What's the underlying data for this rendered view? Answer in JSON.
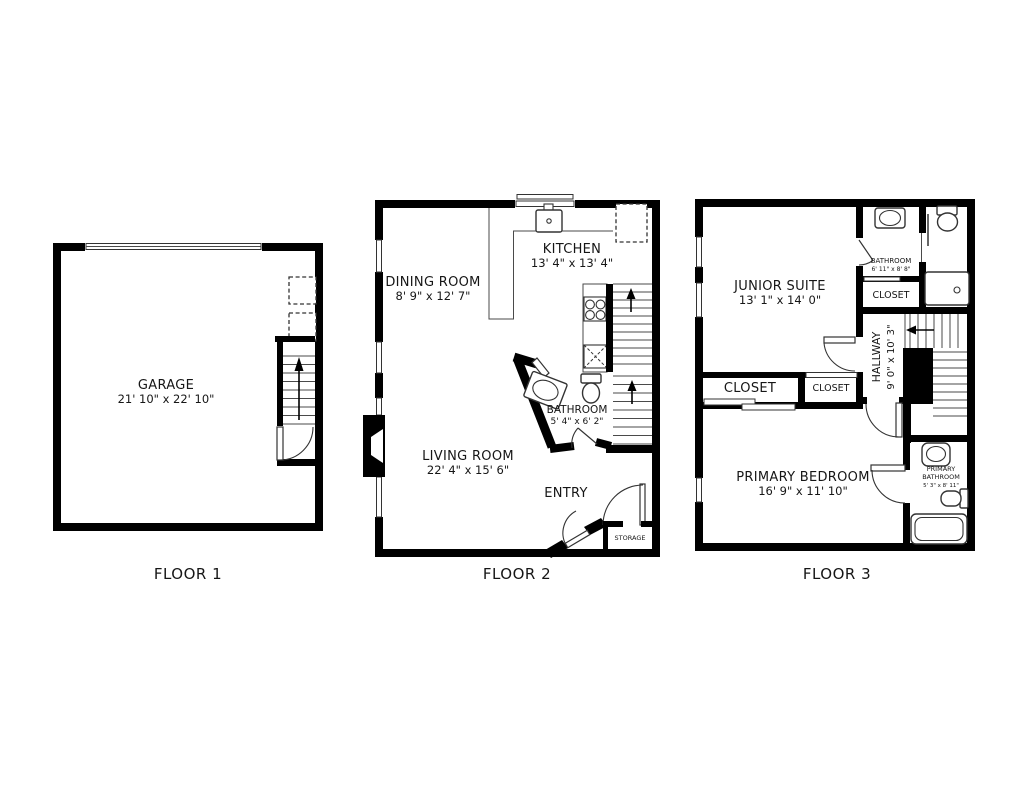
{
  "title": "Three-floor townhouse floor plan",
  "colors": {
    "background": "#ffffff",
    "walls": "#000000",
    "fixtures": "#333333",
    "text": "#161616"
  },
  "floors": [
    {
      "label": "FLOOR 1",
      "rooms": [
        {
          "name": "GARAGE",
          "dims": "21' 10\" x 22' 10\""
        }
      ]
    },
    {
      "label": "FLOOR 2",
      "rooms": [
        {
          "name": "DINING ROOM",
          "dims": "8' 9\" x 12' 7\""
        },
        {
          "name": "KITCHEN",
          "dims": "13' 4\" x 13' 4\""
        },
        {
          "name": "BATHROOM",
          "dims": "5' 4\" x 6' 2\""
        },
        {
          "name": "LIVING ROOM",
          "dims": "22' 4\" x 15' 6\""
        },
        {
          "name": "ENTRY"
        },
        {
          "name": "STORAGE"
        }
      ]
    },
    {
      "label": "FLOOR 3",
      "rooms": [
        {
          "name": "JUNIOR SUITE",
          "dims": "13' 1\" x 14' 0\""
        },
        {
          "name": "BATHROOM",
          "dims": "6' 11\" x 8' 8\""
        },
        {
          "name": "CLOSET"
        },
        {
          "name": "HALLWAY",
          "dims": "9' 0\" x 10' 3\""
        },
        {
          "name": "CLOSET"
        },
        {
          "name": "CLOSET"
        },
        {
          "name": "PRIMARY BEDROOM",
          "dims": "16' 9\" x 11' 10\""
        },
        {
          "name": "PRIMARY BATHROOM",
          "name_lines": [
            "PRIMARY",
            "BATHROOM"
          ],
          "dims": "5' 3\" x 8' 11\""
        }
      ]
    }
  ]
}
